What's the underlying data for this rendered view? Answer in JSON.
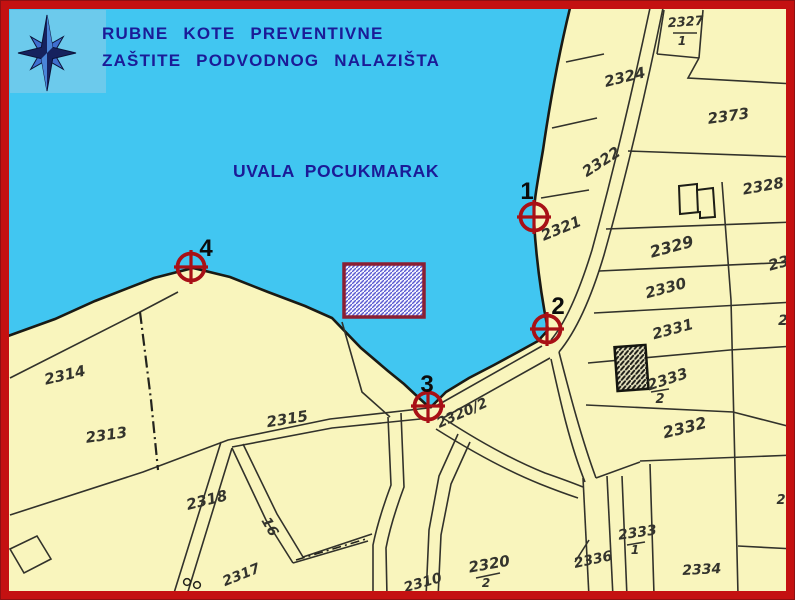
{
  "header": {
    "title_line1": "RUBNE  KOTE  PREVENTIVNE",
    "title_line2": "ZAŠTITE  PODVODNOG  NALAZIŠTA"
  },
  "bay": {
    "name": "UVALA POCUKMARAK"
  },
  "markers": [
    {
      "id": "1",
      "x": 534,
      "y": 217,
      "label_x": 527,
      "label_y": 199
    },
    {
      "id": "2",
      "x": 547,
      "y": 329,
      "label_x": 558,
      "label_y": 314
    },
    {
      "id": "3",
      "x": 428,
      "y": 406,
      "label_x": 427,
      "label_y": 392
    },
    {
      "id": "4",
      "x": 191,
      "y": 267,
      "label_x": 206,
      "label_y": 256
    }
  ],
  "site_area": {
    "x": 344,
    "y": 264,
    "width": 80,
    "height": 53
  },
  "parcels": [
    {
      "text": "2327",
      "x": 686,
      "y": 26,
      "rot": -4,
      "size": 13
    },
    {
      "text": "1",
      "x": 682,
      "y": 45,
      "rot": 0,
      "size": 12
    },
    {
      "text": "2324",
      "x": 626,
      "y": 82,
      "rot": -14,
      "size": 15
    },
    {
      "text": "2373",
      "x": 729,
      "y": 121,
      "rot": -8,
      "size": 15
    },
    {
      "text": "2322",
      "x": 604,
      "y": 166,
      "rot": -33,
      "size": 15
    },
    {
      "text": "2328",
      "x": 764,
      "y": 191,
      "rot": -10,
      "size": 15
    },
    {
      "text": "2321",
      "x": 563,
      "y": 233,
      "rot": -22,
      "size": 15
    },
    {
      "text": "2329",
      "x": 673,
      "y": 252,
      "rot": -15,
      "size": 16
    },
    {
      "text": "23",
      "x": 780,
      "y": 268,
      "rot": -15,
      "size": 15
    },
    {
      "text": "2330",
      "x": 667,
      "y": 293,
      "rot": -15,
      "size": 15
    },
    {
      "text": "2",
      "x": 783,
      "y": 325,
      "rot": 0,
      "size": 14
    },
    {
      "text": "2331",
      "x": 674,
      "y": 334,
      "rot": -15,
      "size": 15
    },
    {
      "text": "2333",
      "x": 669,
      "y": 384,
      "rot": -18,
      "size": 15
    },
    {
      "text": "2",
      "x": 660,
      "y": 403,
      "rot": 0,
      "size": 13
    },
    {
      "text": "2332",
      "x": 686,
      "y": 433,
      "rot": -14,
      "size": 16
    },
    {
      "text": "2",
      "x": 781,
      "y": 504,
      "rot": 0,
      "size": 13
    },
    {
      "text": "2314",
      "x": 66,
      "y": 380,
      "rot": -13,
      "size": 15
    },
    {
      "text": "2313",
      "x": 107,
      "y": 440,
      "rot": -8,
      "size": 15
    },
    {
      "text": "2315",
      "x": 288,
      "y": 424,
      "rot": -9,
      "size": 15
    },
    {
      "text": "2318",
      "x": 208,
      "y": 505,
      "rot": -14,
      "size": 15
    },
    {
      "text": "16",
      "x": 266,
      "y": 529,
      "rot": 60,
      "size": 14
    },
    {
      "text": "2317",
      "x": 243,
      "y": 579,
      "rot": -22,
      "size": 14
    },
    {
      "text": "2320/2",
      "x": 464,
      "y": 417,
      "rot": -24,
      "size": 14
    },
    {
      "text": "2310",
      "x": 424,
      "y": 587,
      "rot": -16,
      "size": 14
    },
    {
      "text": "2320",
      "x": 490,
      "y": 569,
      "rot": -10,
      "size": 15
    },
    {
      "text": "2",
      "x": 486,
      "y": 587,
      "rot": 0,
      "size": 12
    },
    {
      "text": "2336",
      "x": 594,
      "y": 564,
      "rot": -12,
      "size": 14
    },
    {
      "text": "2333",
      "x": 638,
      "y": 537,
      "rot": -8,
      "size": 14
    },
    {
      "text": "1",
      "x": 635,
      "y": 554,
      "rot": 0,
      "size": 12
    },
    {
      "text": "2334",
      "x": 702,
      "y": 574,
      "rot": -3,
      "size": 14
    }
  ],
  "colors": {
    "sea": "#41c6f1",
    "land": "#f9f5bd",
    "frame": "#c41111",
    "ink": "#32322b",
    "navy": "#1b1b97",
    "marker_red": "#a81016",
    "site_border": "#8a1f33",
    "site_hatch": "#5b5bd0",
    "panel_blue": "#6ccaec"
  }
}
